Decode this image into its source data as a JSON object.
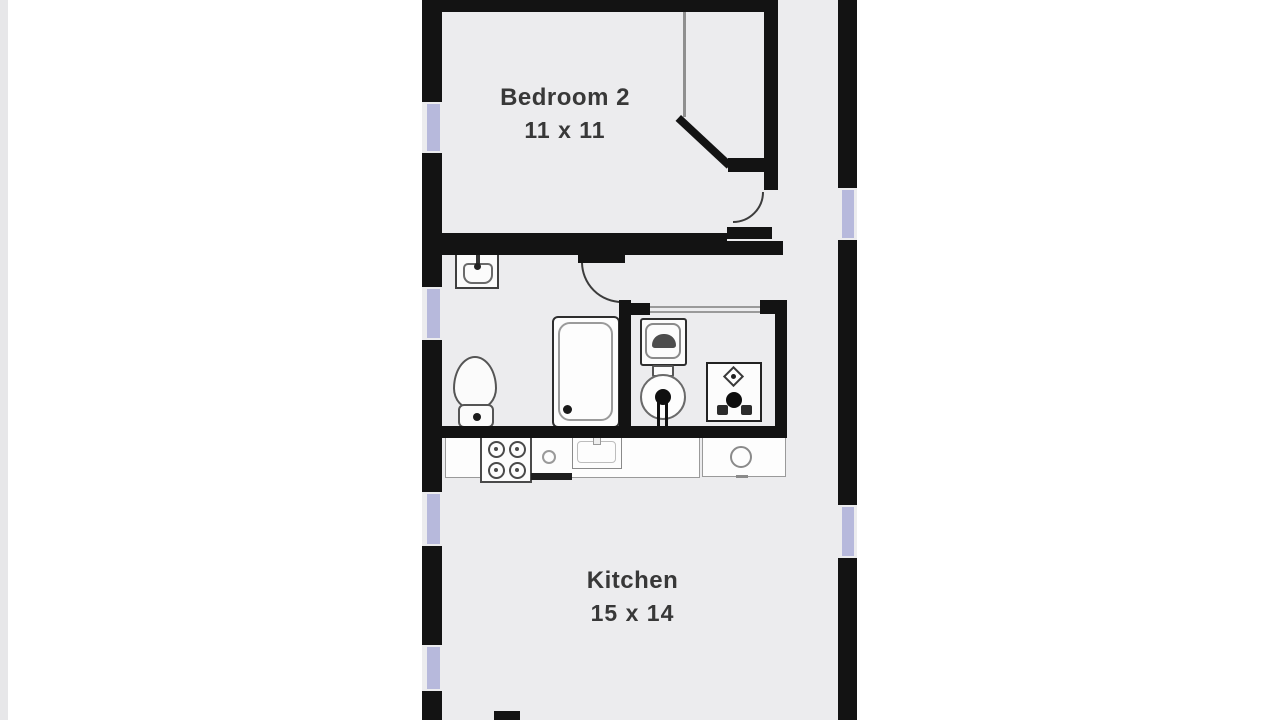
{
  "plan": {
    "type": "floorplan",
    "rooms": [
      {
        "name": "Bedroom 2",
        "dimensions": "11 x 11"
      },
      {
        "name": "Kitchen",
        "dimensions": "15 x 14"
      }
    ],
    "fixtures": [
      "bathroom-sink",
      "toilet",
      "shower",
      "washer",
      "water-heater",
      "furnace",
      "stove",
      "kitchen-sink",
      "counter",
      "closet",
      "doors",
      "windows"
    ],
    "colors": {
      "wall": "#131313",
      "window": "#b7b9dc",
      "floor": "#ececee",
      "label_text": "#383838",
      "fixture_outline": "#4a4a4a"
    }
  }
}
